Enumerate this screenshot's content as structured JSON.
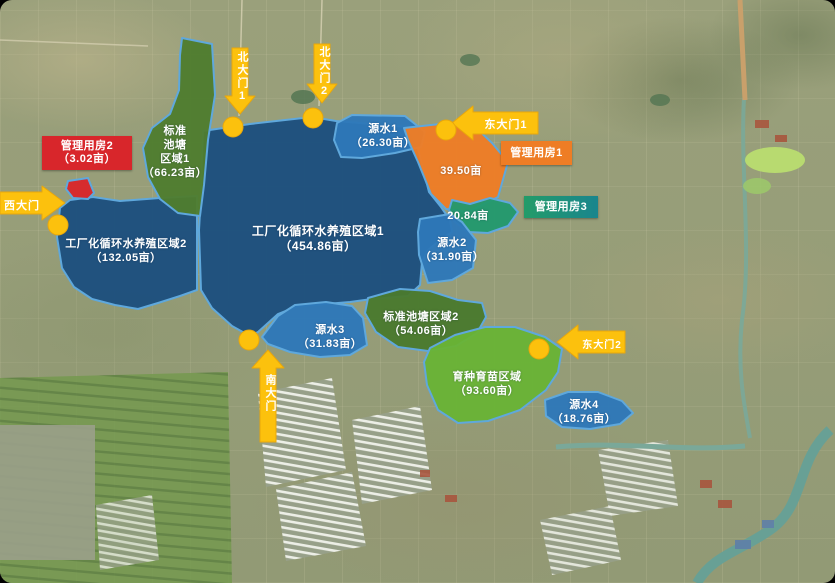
{
  "regions": {
    "area1": {
      "name": "工厂化循环水养殖区域1",
      "area": "（454.86亩）",
      "color": "#1c4f7e"
    },
    "area2": {
      "name": "工厂化循环水养殖区域2",
      "area": "（132.05亩）",
      "color": "#1c4f7e"
    },
    "pond1": {
      "line1": "标准",
      "line2": "池塘",
      "line3": "区域1",
      "area": "（66.23亩）",
      "color": "#4f7d2f"
    },
    "pond2": {
      "name": "标准池塘区域2",
      "area": "（54.06亩）",
      "color": "#4a7a2e"
    },
    "source1": {
      "name": "源水1",
      "area": "（26.30亩）",
      "color": "#2e78b8"
    },
    "source2": {
      "name": "源水2",
      "area": "（31.90亩）",
      "color": "#2e78b8"
    },
    "source3": {
      "name": "源水3",
      "area": "（31.83亩）",
      "color": "#2e78b8"
    },
    "source4": {
      "name": "源水4",
      "area": "（18.76亩）",
      "color": "#2e78b8"
    },
    "orange_plot": {
      "area": "39.50亩",
      "color": "#ee7d25"
    },
    "teal_plot": {
      "area": "20.84亩",
      "color": "#22996d"
    },
    "nursery": {
      "name": "育种育苗区域",
      "area": "（93.60亩）",
      "color": "#69b335"
    },
    "red_plot": {
      "color": "#d8262b"
    }
  },
  "buildings": {
    "mgmt1": {
      "label": "管理用房1",
      "color": "#ee7d25"
    },
    "mgmt2": {
      "label": "管理用房2",
      "area": "（3.02亩）",
      "color": "#d8262b"
    },
    "mgmt3": {
      "label": "管理用房3",
      "color": "#1f9476"
    }
  },
  "gates": {
    "north1": {
      "label": "北大门1"
    },
    "north2": {
      "label": "北大门2"
    },
    "east1": {
      "label": "东大门1"
    },
    "east2": {
      "label": "东大门2"
    },
    "west": {
      "label": "西大门"
    },
    "south": {
      "label": "南大门"
    }
  },
  "colors": {
    "gate": "#fcc10d",
    "region_outline": "#5fa8dc",
    "label_text": "#ffffff"
  }
}
